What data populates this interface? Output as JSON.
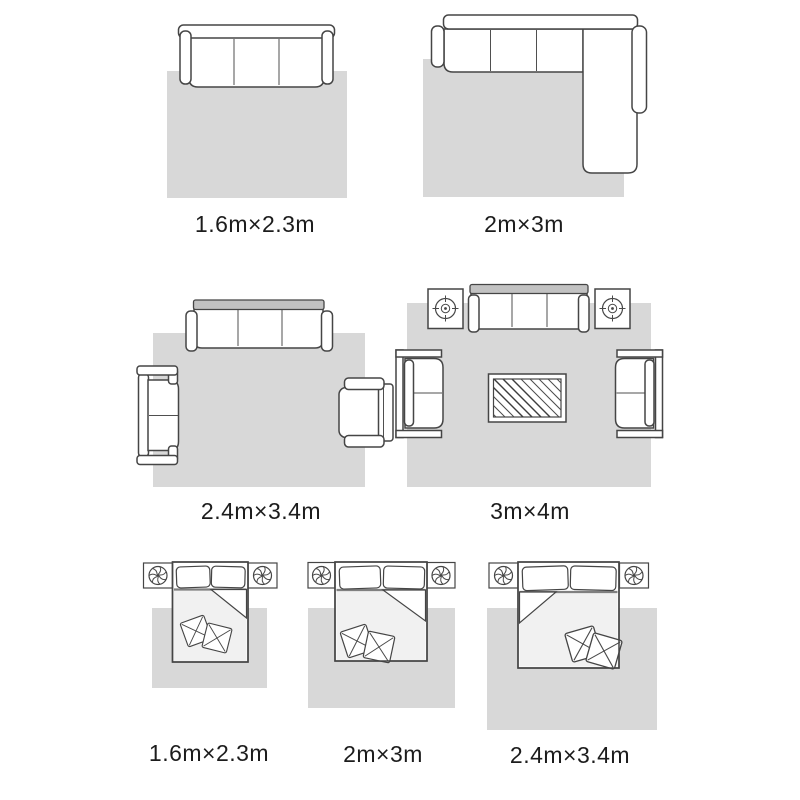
{
  "colors": {
    "background": "#ffffff",
    "rug": "#d8d8d8",
    "furniture_outline": "#454545",
    "sofa_backrest": "#c2c2c2",
    "bed_sheet": "#f1f1f1",
    "label_text": "#1c1c1c"
  },
  "diagrams": [
    {
      "scene": "three-seat-sofa-with-rug",
      "label": "1.6m×2.3m"
    },
    {
      "scene": "l-shaped-sectional-sofa-with-rug",
      "label": "2m×3m"
    },
    {
      "scene": "living-room-sofa-loveseat-armchair-with-rug",
      "label": "2.4m×3.4m"
    },
    {
      "scene": "living-room-full-set-with-coffee-table-rug",
      "label": "3m×4m"
    },
    {
      "scene": "bed-with-nightstands-and-rug",
      "label": "1.6m×2.3m"
    },
    {
      "scene": "bed-with-nightstands-and-rug",
      "label": "2m×3m"
    },
    {
      "scene": "bed-with-nightstands-and-rug",
      "label": "2.4m×3.4m"
    }
  ],
  "icons": {
    "plant-icon": "swirl potted plant, top view (circle with curved leaves)",
    "potted-plant-icon": "compass-style pot: concentric circles with cross ticks",
    "coffee-table-icon": "double-frame rectangle with diagonal glass hatching",
    "sofa-icon": "top-view sofa: backrest bar, seat cushions, armrest pills",
    "bed-icon": "top-view bed: pillows, folded blanket corner, throw cushions",
    "rug-swatch": "light gray rectangle"
  }
}
